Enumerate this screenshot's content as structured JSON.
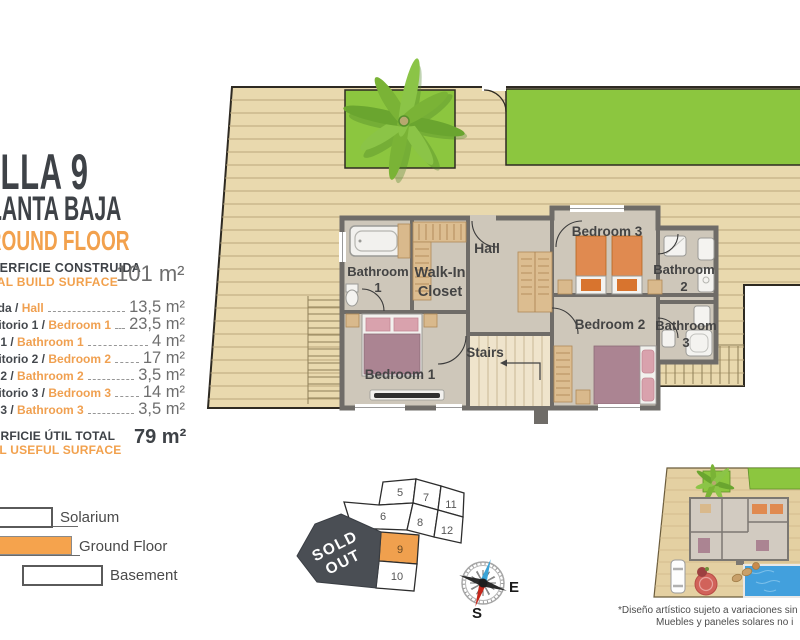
{
  "page": {
    "title": "VILLA 9",
    "floor_es": "PLANTA BAJA",
    "floor_en": "GROUND FLOOR"
  },
  "build_surface": {
    "label_es": "SUPERFICIE CONSTRUIDA",
    "label_en": "TOTAL BUILD SURFACE",
    "value": "101 m²"
  },
  "rooms": [
    {
      "es": "Entrada",
      "en": "Hall",
      "value": "13,5 m²"
    },
    {
      "es": "Dormitorio 1",
      "en": "Bedroom 1",
      "value": "23,5 m²"
    },
    {
      "es": "Baño 1",
      "en": "Bathroom 1",
      "value": "4 m²"
    },
    {
      "es": "Dormitorio 2",
      "en": "Bedroom 2",
      "value": "17 m²"
    },
    {
      "es": "Baño 2",
      "en": "Bathroom 2",
      "value": "3,5 m²"
    },
    {
      "es": "Dormitorio 3",
      "en": "Bedroom 3",
      "value": "14 m²"
    },
    {
      "es": "Baño 3",
      "en": "Bathroom 3",
      "value": "3,5 m²"
    }
  ],
  "useful_surface": {
    "label_es": "SUPERFICIE ÚTIL TOTAL",
    "label_en": "TOTAL USEFUL SURFACE",
    "value": "79 m²"
  },
  "legend": [
    {
      "label": "Solarium"
    },
    {
      "label": "Ground Floor"
    },
    {
      "label": "Basement"
    }
  ],
  "floorplan_labels": {
    "bathroom1_l1": "Bathroom",
    "bathroom1_l2": "1",
    "walkin_l1": "Walk-In",
    "walkin_l2": "Closet",
    "hall": "Hall",
    "bedroom3": "Bedroom 3",
    "bathroom2_l1": "Bathroom",
    "bathroom2_l2": "2",
    "bedroom2": "Bedroom 2",
    "bathroom3_l1": "Bathroom",
    "bathroom3_l2": "3",
    "bedroom1": "Bedroom 1",
    "stairs": "Stairs"
  },
  "plot_map": {
    "sold_line1": "SOLD",
    "sold_line2": "OUT",
    "plots": [
      "5",
      "7",
      "11",
      "6",
      "8",
      "12",
      "9",
      "10"
    ],
    "highlighted_plot": "9"
  },
  "compass": {
    "e": "E",
    "s": "S"
  },
  "disclaimer": {
    "line1": "*Diseño artístico sujeto a variaciones sin valor con",
    "line2": "Muebles y paneles solares no i"
  },
  "colors": {
    "accent_orange": "#F2A14D",
    "dark_text": "#3E4247",
    "deck_tan": "#E9D9AE",
    "lawn_green": "#8CC63F",
    "wall_gray": "#6F6C68",
    "sold_out_bg": "#4A4E54",
    "highlight_plot": "#F0A04E",
    "pool_blue": "#42A0DD"
  }
}
